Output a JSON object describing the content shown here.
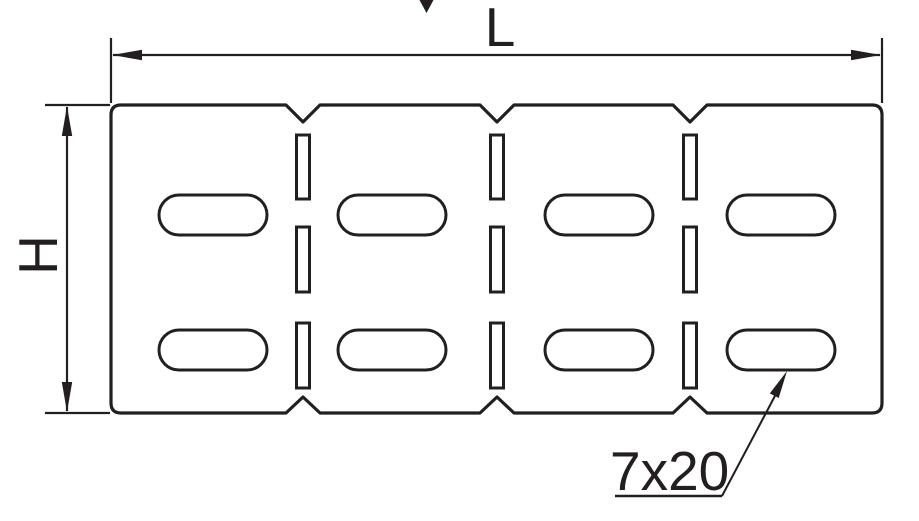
{
  "figure": {
    "dimension_labels": {
      "length": "L",
      "height": "H"
    },
    "callout": {
      "slot_size_label": "7x20"
    },
    "colors": {
      "line": "#231f20",
      "background": "#ffffff"
    },
    "feature_counts": {
      "oblong_slots": 8,
      "rectangular_slots": 9,
      "top_notches": 3,
      "bottom_notches": 3
    }
  }
}
